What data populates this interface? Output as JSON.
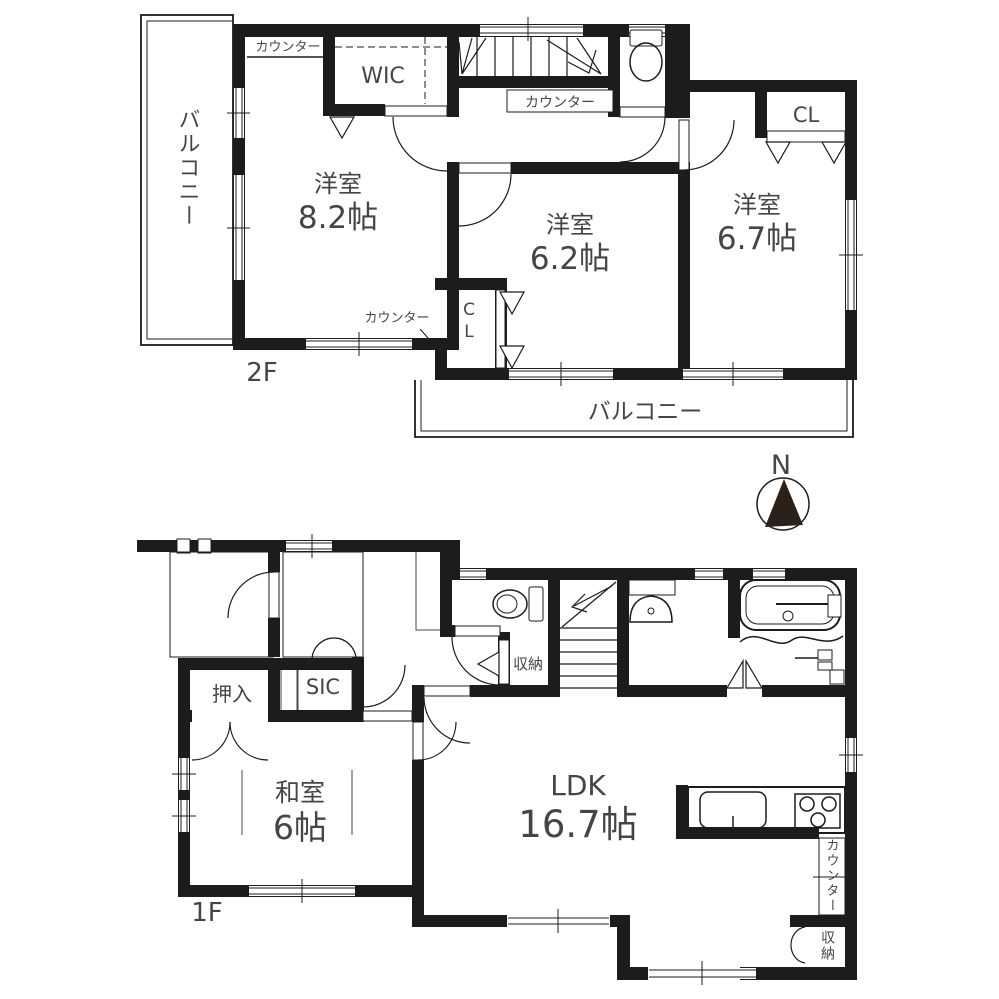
{
  "palette": {
    "wall": "#1c1c1c",
    "ink": "#454545",
    "paper": "#ffffff",
    "compass": "#2b2119"
  },
  "compass": {
    "label": "N"
  },
  "floor2": {
    "floor_label": "2F",
    "balcony_left": "バルコニー",
    "balcony_rear": "バルコニー",
    "counter_top": "カウンター",
    "counter_stairs": "カウンター",
    "counter_bottom": "カウンター",
    "wic": "WIC",
    "closet_62": "CL",
    "closet_67": "CL",
    "rooms": [
      {
        "name": "洋室",
        "size": "8.2帖"
      },
      {
        "name": "洋室",
        "size": "6.2帖"
      },
      {
        "name": "洋室",
        "size": "6.7帖"
      }
    ]
  },
  "floor1": {
    "floor_label": "1F",
    "oshiire": "押入",
    "sic": "SIC",
    "storage_hall": "収納",
    "storage_kitchen": "収納",
    "counter_kitchen": "カウンター",
    "rooms": [
      {
        "name": "和室",
        "size": "6帖"
      },
      {
        "name": "LDK",
        "size": "16.7帖"
      }
    ]
  }
}
